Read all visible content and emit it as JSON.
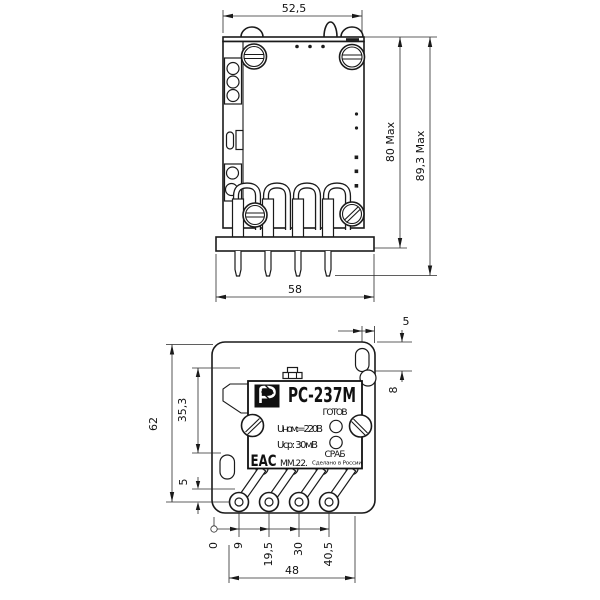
{
  "side_view": {
    "dim_overall_width": "52,5",
    "dim_body_height": "80 Max",
    "dim_overall_height": "89,3 Max",
    "dim_socket_width": "58"
  },
  "bottom_view": {
    "dim_slot_to_edge": "5",
    "dim_edge_offset": "8",
    "dim_overall_height": "62",
    "dim_hole_offset": "35,3",
    "dim_pin_row_offset": "5",
    "pin_coords": {
      "datum": "0",
      "pin1": "9",
      "pin2": "19,5",
      "pin3": "30",
      "pin4": "40,5"
    },
    "dim_pin_span": "48",
    "nameplate": {
      "model": "РС-237М",
      "led_ready_label": "ГОТОВ",
      "led_operate_label": "СРАБ",
      "line_nominal": "Uном:=220В",
      "line_pickup": "Uср: 30мВ",
      "eac_mark": "ЕАС",
      "date_code": "ММ.22.",
      "made_in": "Сделано в России"
    }
  }
}
